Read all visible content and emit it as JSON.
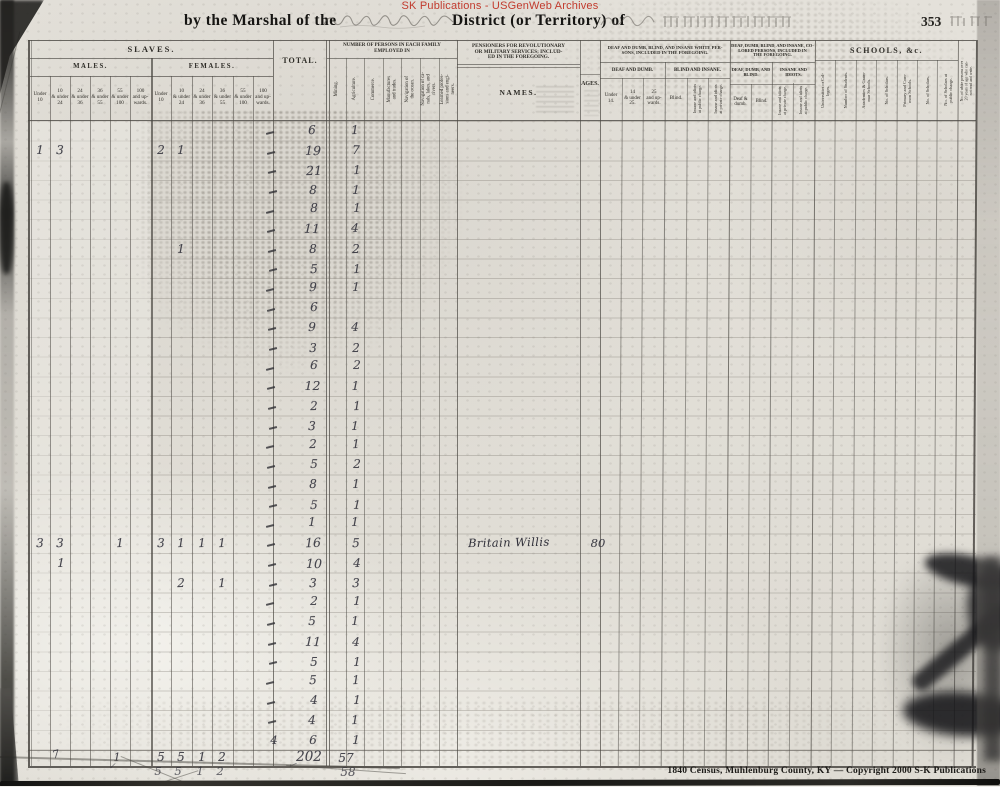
{
  "watermark": {
    "text": "SK Publications - USGenWeb Archives",
    "color": "#c23b2e"
  },
  "header": {
    "prefix": "by the Marshal of the",
    "middle": "District (or Territory) of",
    "page_number": "353"
  },
  "table": {
    "slaves": {
      "title": "SLAVES.",
      "males_title": "MALES.",
      "females_title": "FEMALES.",
      "male_labels": [
        "Under\n10",
        "10\n& under\n24",
        "24\n& under\n36",
        "36\n& under\n55",
        "55\n& under\n100",
        "100\nand up-\nwards."
      ],
      "female_labels": [
        "Under\n10",
        "10\n& under\n24",
        "24\n& under\n36",
        "36\n& under\n55",
        "55\n& under\n100",
        "100\nand up-\nwards."
      ]
    },
    "total_label": "TOTAL.",
    "employed": {
      "title": "NUMBER OF PERSONS IN EACH FAMILY\nEMPLOYED IN",
      "labels": [
        "Mining.",
        "Agriculture.",
        "Commerce.",
        "Manufactures\nand trades.",
        "Navigation of\nthe ocean.",
        "Navigation of ca-\nnals, lakes, and\nrivers.",
        "Learned profes-\nsions and engi-\nneers."
      ]
    },
    "pensioners": {
      "title": "PENSIONERS FOR REVOLUTIONARY\nOR MILITARY SERVICES; INCLUD-\nED IN THE FOREGOING.",
      "names_label": "NAMES.",
      "ages_label": "AGES."
    },
    "white_impaired": {
      "title": "DEAF AND DUMB, BLIND, AND INSANE WHITE PER-\nSONS, INCLUDED IN THE FOREGOING.",
      "deaf_dumb_title": "DEAF AND DUMB.",
      "deaf_dumb_labels": [
        "Under\n14.",
        "14\n& under\n25.",
        "25\nand up-\nwards."
      ],
      "blind_insane_title": "BLIND AND INSANE.",
      "blind_label": "Blind.",
      "insane_labels": [
        "Insane and idiots\nat public charge.",
        "Insane and idiots\nat private charge."
      ]
    },
    "colored_impaired": {
      "title": "DEAF, DUMB, BLIND, AND INSANE, CO-\nLORED PERSONS, INCLUDED IN\nTHE FOREGOING.",
      "deaf_dumb_blind_title": "DEAF, DUMB, AND\nBLIND.",
      "deaf_dumb_label": "Deaf &\ndumb.",
      "blind_label": "Blind.",
      "insane_idiots_title": "INSANE AND\nIDIOTS.",
      "insane_labels": [
        "Insane and idiots\nat private charge.",
        "Insane and idiots\nat public charge."
      ]
    },
    "schools": {
      "title": "SCHOOLS, &c.",
      "labels": [
        "Universities or Col-\nleges.",
        "Number of Students.",
        "Academies & Gram-\nmar Schools.",
        "No. of Scholars.",
        "Primary and Com-\nmon Schools.",
        "No. of Scholars.",
        "No. of Scholars at\npublic charge."
      ]
    },
    "literacy_label": "No. of white persons over\n20 years of age who can-\nnot read and write."
  },
  "rows": [
    {
      "total": "6",
      "agriculture": "1",
      "tick": true
    },
    {
      "m_under_10": "1",
      "m_10_24": "3",
      "f_under_10": "2",
      "f_10_24": "1",
      "total": "19",
      "agriculture": "7",
      "tick": true
    },
    {
      "total": "21",
      "agriculture": "1",
      "tick": true
    },
    {
      "total": "8",
      "agriculture": "1",
      "tick": true
    },
    {
      "total": "8",
      "agriculture": "1",
      "tick": true
    },
    {
      "total": "11",
      "agriculture": "4",
      "tick": true
    },
    {
      "f_10_24": "1",
      "total": "8",
      "agriculture": "2",
      "tick": true
    },
    {
      "total": "5",
      "agriculture": "1",
      "tick": true
    },
    {
      "total": "9",
      "agriculture": "1",
      "tick": true
    },
    {
      "total": "6",
      "tick": true
    },
    {
      "total": "9",
      "agriculture": "4",
      "tick": true
    },
    {
      "total": "3",
      "agriculture": "2",
      "tick": true
    },
    {
      "total": "6",
      "agriculture": "2",
      "tick": true
    },
    {
      "total": "12",
      "agriculture": "1",
      "tick": true
    },
    {
      "total": "2",
      "agriculture": "1",
      "tick": true
    },
    {
      "total": "3",
      "agriculture": "1",
      "tick": true
    },
    {
      "total": "2",
      "agriculture": "1",
      "tick": true
    },
    {
      "total": "5",
      "agriculture": "2",
      "tick": true
    },
    {
      "total": "8",
      "agriculture": "1",
      "tick": true
    },
    {
      "total": "5",
      "agriculture": "1",
      "tick": true
    },
    {
      "total": "1",
      "agriculture": "1",
      "tick": true
    },
    {
      "m_under_10": "3",
      "m_10_24": "3",
      "m_55_100": "1",
      "f_under_10": "3",
      "f_10_24": "1",
      "f_24_36": "1",
      "f_36_55": "1",
      "total": "16",
      "agriculture": "5",
      "pensioner_name": "Britain Willis",
      "pensioner_age": "80",
      "tick": true
    },
    {
      "m_10_24": "1",
      "total": "10",
      "agriculture": "4",
      "tick": true
    },
    {
      "f_10_24": "2",
      "f_36_55": "1",
      "total": "3",
      "agriculture": "3",
      "tick": true
    },
    {
      "total": "2",
      "agriculture": "1",
      "tick": true
    },
    {
      "total": "5",
      "agriculture": "1",
      "tick": true
    },
    {
      "total": "11",
      "agriculture": "4",
      "tick": true
    },
    {
      "total": "5",
      "agriculture": "1",
      "tick": true
    },
    {
      "total": "5",
      "agriculture": "1",
      "tick": true
    },
    {
      "total": "4",
      "agriculture": "1",
      "tick": true
    },
    {
      "total": "4",
      "agriculture": "1",
      "tick": true
    },
    {
      "tick_value": "4",
      "total": "6",
      "agriculture": "1"
    }
  ],
  "tallies": {
    "female_totals": [
      "5",
      "5",
      "1",
      "2"
    ],
    "male_marks": [
      "7",
      "1"
    ],
    "grand_total": "202",
    "agriculture_total": "57",
    "recount_female": [
      "5",
      "5",
      "1",
      "2"
    ],
    "recount_agriculture": "58"
  },
  "footer": {
    "credit": "1840 Census, Muhlenburg County, KY — Copyright 2000 S-K Publications"
  },
  "ink_color": "#30303a",
  "paper_color": "#e1ded7"
}
